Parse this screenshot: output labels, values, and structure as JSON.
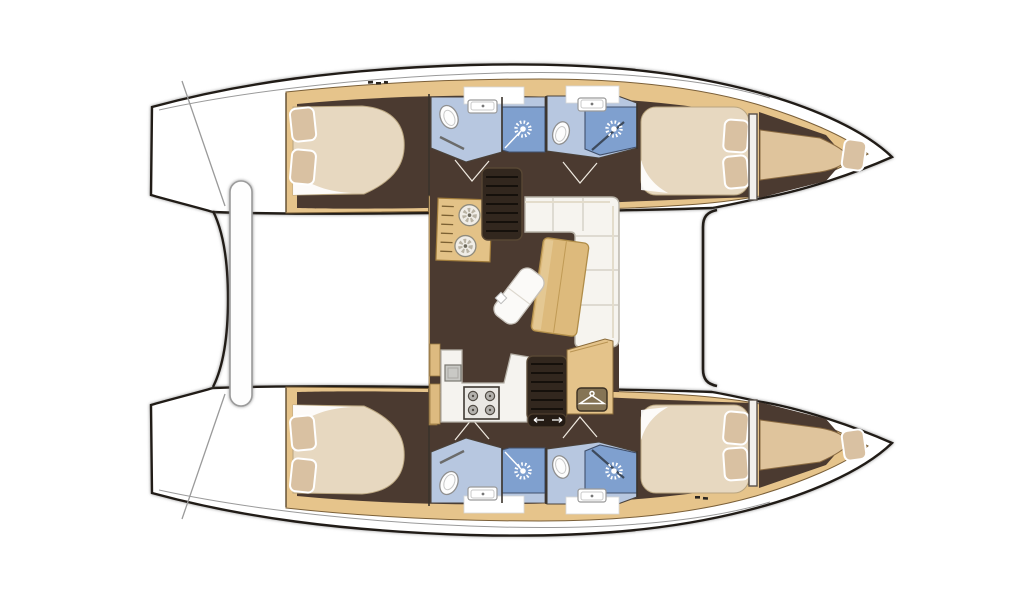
{
  "meta": {
    "title": "Catamaran yacht interior layout plan (top view)",
    "diagram_type": "boat-floor-plan",
    "orientation": "bows pointing right, stern transoms left",
    "canvas": {
      "width": 1024,
      "height": 600
    }
  },
  "vessel": {
    "hulls": 2,
    "summary": "4 double cabins, 2 forepeak berths, 4 bathrooms with separate showers, central saloon with galley, nav desk, dinette sofa and wardrobe",
    "port_hull": {
      "rooms": [
        {
          "id": "port-aft-cabin",
          "label": "Aft double cabin",
          "features": [
            "island double bed",
            "2 pillows"
          ]
        },
        {
          "id": "port-aft-bathroom",
          "label": "Aft bathroom",
          "features": [
            "toilet",
            "washbasin",
            "shower stall",
            "door"
          ]
        },
        {
          "id": "port-fwd-bathroom",
          "label": "Forward bathroom",
          "features": [
            "toilet",
            "washbasin",
            "shower stall"
          ]
        },
        {
          "id": "port-forward-cabin",
          "label": "Forward double cabin",
          "features": [
            "double bed",
            "2 pillows"
          ]
        },
        {
          "id": "port-forepeak",
          "label": "Forepeak berth",
          "features": [
            "single berth",
            "1 pillow"
          ]
        }
      ]
    },
    "starboard_hull": {
      "rooms": [
        {
          "id": "stbd-aft-cabin",
          "label": "Aft double cabin",
          "features": [
            "island double bed",
            "2 pillows"
          ]
        },
        {
          "id": "stbd-aft-bathroom",
          "label": "Aft bathroom",
          "features": [
            "toilet",
            "washbasin",
            "shower stall",
            "door"
          ]
        },
        {
          "id": "stbd-fwd-bathroom",
          "label": "Forward bathroom",
          "features": [
            "toilet",
            "washbasin",
            "shower stall"
          ]
        },
        {
          "id": "stbd-forward-cabin",
          "label": "Forward double cabin",
          "features": [
            "double bed",
            "2 pillows"
          ]
        },
        {
          "id": "stbd-forepeak",
          "label": "Forepeak berth",
          "features": [
            "single berth",
            "1 pillow"
          ]
        }
      ]
    },
    "saloon": {
      "items": [
        "nav desk with two round dials",
        "companionway stairs to port hull",
        "L-shaped dinette sofa",
        "folding saloon table",
        "chaise seat",
        "galley counter",
        "4-burner stove",
        "galley sink",
        "companionway stairs to starboard hull",
        "sliding-step landing with arrows",
        "wardrobe with hanger icon"
      ]
    },
    "deck": {
      "items": [
        "port stern transom with steps",
        "starboard stern transom with steps",
        "dinghy / aft crossbar between transoms",
        "forward crossbeam line",
        "bow points",
        "deck hatch tick marks"
      ]
    }
  },
  "icons": {
    "shower-head": "white starburst on blue stall",
    "toilet": "white oval bowl",
    "washbasin": "white rounded rectangle with tap dot",
    "stove": "square with 4 burner circles",
    "wardrobe-hanger": "clothes hanger glyph in rounded badge",
    "stairs": "dark ladder treads",
    "dial": "petal-pattern circle on nav desk"
  },
  "colors": {
    "line": "#211c17",
    "wood": "#e6c48b",
    "woodDark": "#8a6b3a",
    "floor": "#4b3a30",
    "bed": "#e7d8c0",
    "pillow": "#d9c1a2",
    "bath": "#b7c7e0",
    "shower": "#7fa0cf",
    "sofa": "#f6f4ef",
    "table": "#ddba7c",
    "counter": "#f5f3ef",
    "steps": "#32271e",
    "deskTan": "#e3c287",
    "berth": "#dfc49c",
    "grey": "#9a9a9a",
    "white": "#ffffff"
  }
}
